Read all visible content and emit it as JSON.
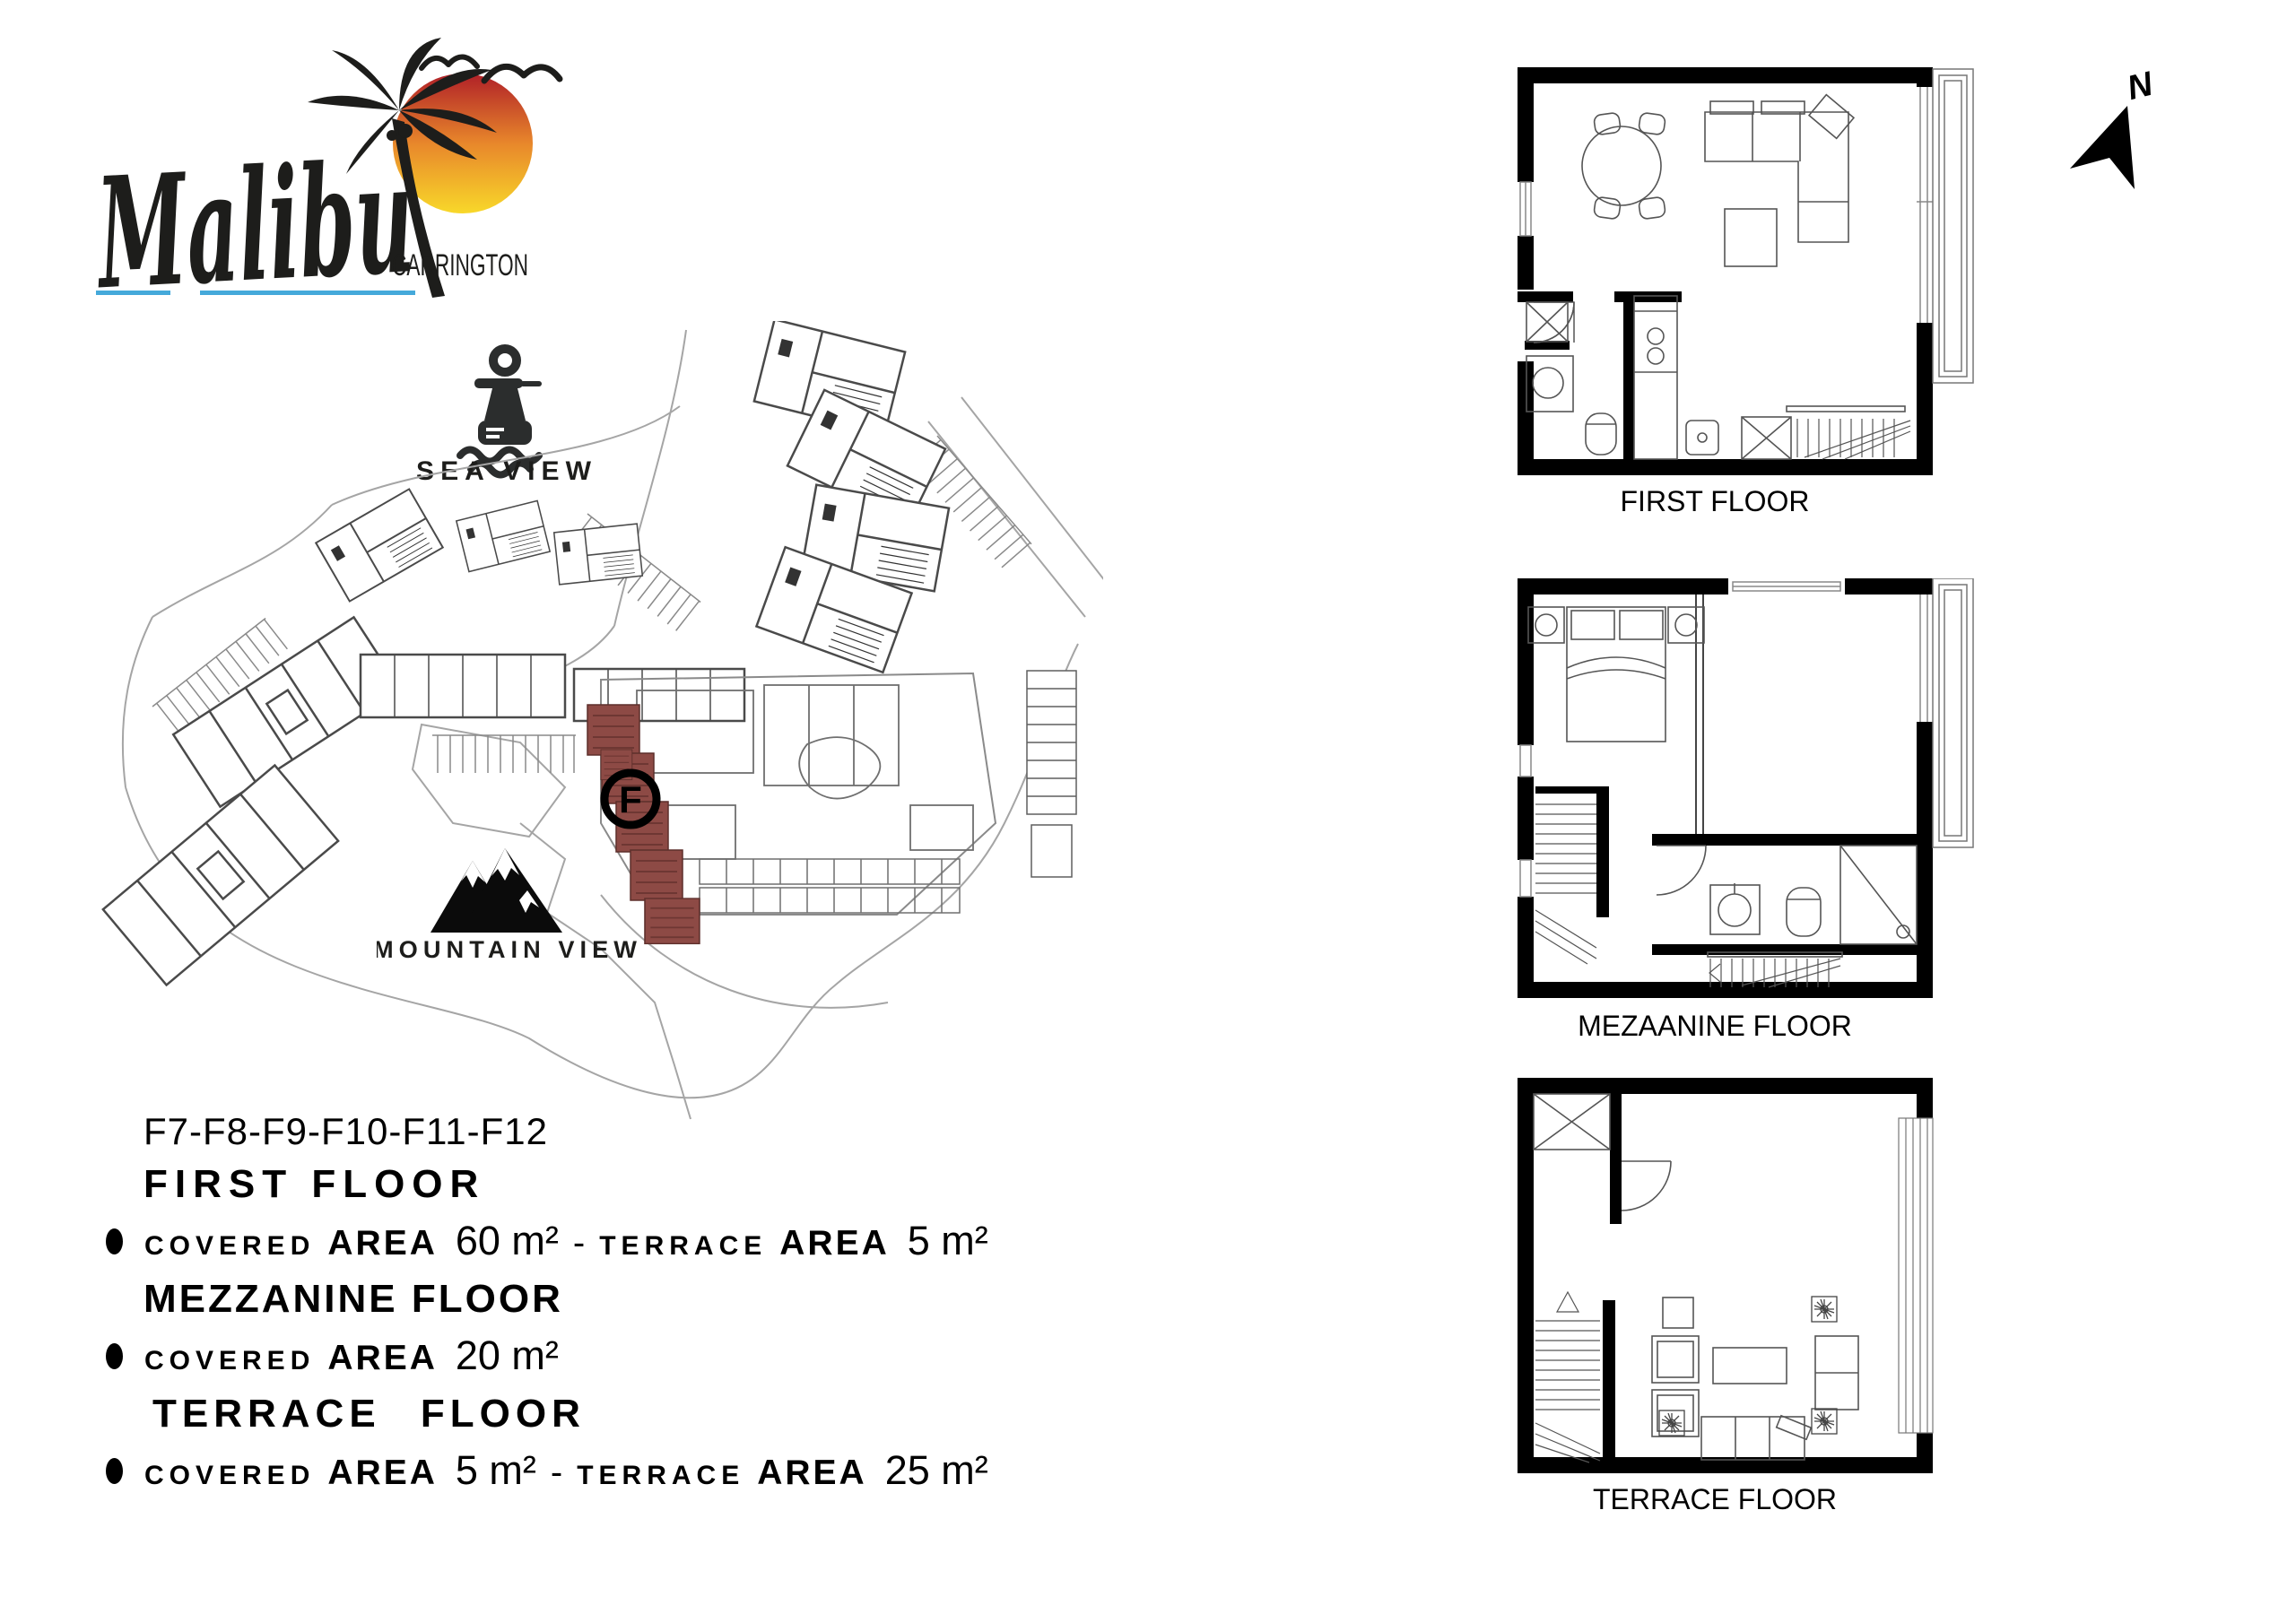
{
  "brand": {
    "name": "Malibu",
    "subtitle": "CARRINGTON"
  },
  "compass": {
    "label": "N"
  },
  "views": {
    "sea": {
      "label": "SEA VIEW"
    },
    "mountain": {
      "label": "MOUNTAIN VIEW"
    }
  },
  "site_plan": {
    "unit_marker": "F",
    "highlight_color": "#8D4A45"
  },
  "unit_info": {
    "units": "F7-F8-F9-F10-F11-F12",
    "separator": "-",
    "sections": [
      {
        "title": "FIRST FLOOR",
        "specs": [
          {
            "label_word1": "COVERED",
            "label_word2": "AREA",
            "value": "60 m²"
          },
          {
            "label_word1": "TERRACE",
            "label_word2": "AREA",
            "value": "5 m²"
          }
        ]
      },
      {
        "title": "MEZZANINE FLOOR",
        "specs": [
          {
            "label_word1": "COVERED",
            "label_word2": "AREA",
            "value": "20 m²"
          }
        ]
      },
      {
        "title": "TERRACE FLOOR",
        "specs": [
          {
            "label_word1": "COVERED",
            "label_word2": "AREA",
            "value": "5 m²"
          },
          {
            "label_word1": "TERRACE",
            "label_word2": "AREA",
            "value": "25 m²"
          }
        ]
      }
    ]
  },
  "floor_plans": [
    {
      "label": "FIRST FLOOR"
    },
    {
      "label": "MEZAANINE FLOOR"
    },
    {
      "label": "TERRACE FLOOR"
    }
  ],
  "colors": {
    "accent_red": "#8D4A45",
    "underline_blue": "#45A9DA",
    "sun_top": "#B02028",
    "sun_mid": "#E8872B",
    "sun_bottom": "#F8D82A",
    "ink": "#1D1D1B"
  }
}
